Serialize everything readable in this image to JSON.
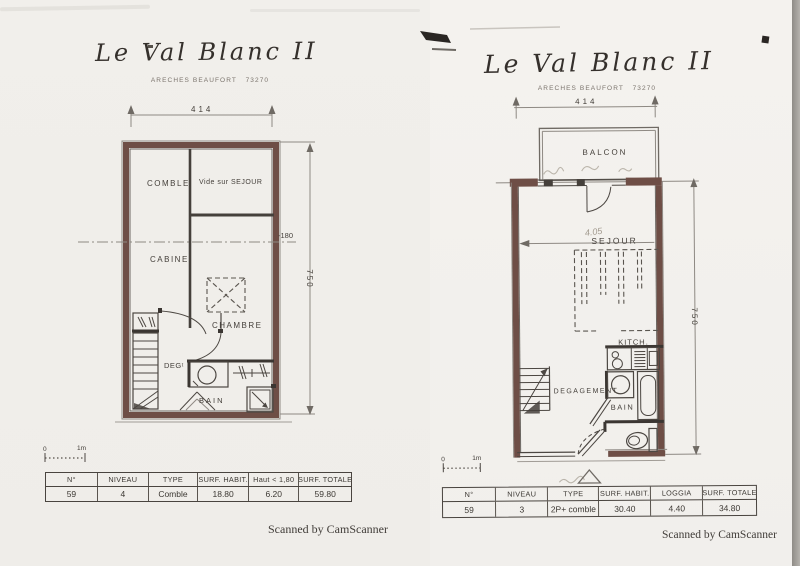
{
  "left_page": {
    "title": "Le Val Blanc II",
    "subtitle": "ARECHES BEAUFORT   73270",
    "plan": {
      "dim_width": "414",
      "dim_height": "750",
      "height_marker": "-180",
      "room_comble": "COMBLE",
      "room_vide": "Vide sur SEJOUR",
      "room_cabine": "CABINE",
      "room_chambre": "CHAMBRE",
      "room_degagement": "DEGᵗ",
      "room_bain": "BAIN"
    },
    "scale_bar": {
      "zero": "0",
      "one_m": "1m"
    },
    "table": {
      "headers": [
        "N°",
        "NIVEAU",
        "TYPE",
        "SURF. HABIT.",
        "Haut < 1,80",
        "SURF. TOTALE"
      ],
      "row": [
        "59",
        "4",
        "Comble",
        "18.80",
        "6.20",
        "59.80"
      ]
    },
    "footer": "Scanned by CamScanner"
  },
  "right_page": {
    "title": "Le Val Blanc II",
    "subtitle": "ARECHES BEAUFORT   73270",
    "plan": {
      "dim_width": "414",
      "dim_height": "750",
      "room_balcon": "BALCON",
      "room_sejour": "SEJOUR",
      "room_kitch": "KITCH.",
      "room_degagement": "DEGAGEMENT",
      "room_bain": "BAIN",
      "handwritten_note": "4.05"
    },
    "scale_bar": {
      "zero": "0",
      "one_m": "1m"
    },
    "table": {
      "headers": [
        "N°",
        "NIVEAU",
        "TYPE",
        "SURF. HABIT.",
        "LOGGIA",
        "SURF. TOTALE"
      ],
      "row": [
        "59",
        "3",
        "2P+ comble",
        "30.40",
        "4.40",
        "34.80"
      ]
    },
    "footer": "Scanned by CamScanner"
  }
}
